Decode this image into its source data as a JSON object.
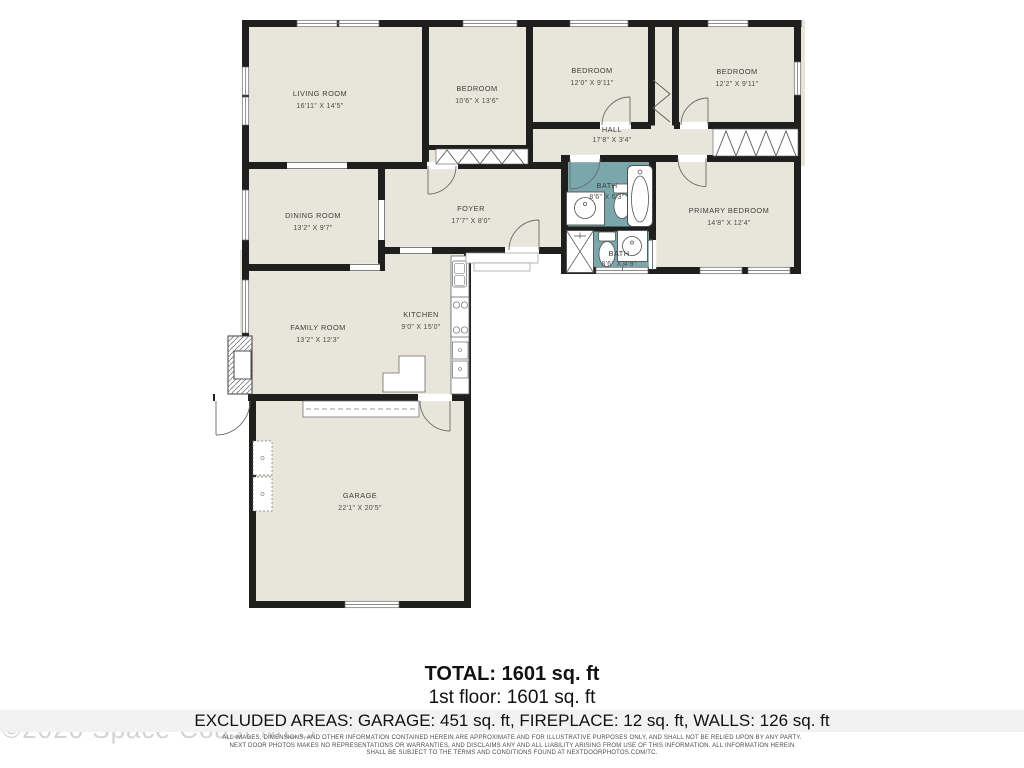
{
  "plan": {
    "rooms": {
      "living": {
        "name": "LIVING ROOM",
        "dims": "16'11\" X 14'5\""
      },
      "bedroom1": {
        "name": "BEDROOM",
        "dims": "10'6\" X 13'6\""
      },
      "bedroom2": {
        "name": "BEDROOM",
        "dims": "12'0\" X 9'11\""
      },
      "bedroom3": {
        "name": "BEDROOM",
        "dims": "12'2\" X 9'11\""
      },
      "hall": {
        "name": "HALL",
        "dims": "17'8\" X 3'4\""
      },
      "foyer": {
        "name": "FOYER",
        "dims": "17'7\" X 8'0\""
      },
      "bath1": {
        "name": "BATH",
        "dims": "8'6\" X 6'3\""
      },
      "bath2": {
        "name": "BATH",
        "dims": "8'6\" X 4'9\""
      },
      "primary": {
        "name": "PRIMARY BEDROOM",
        "dims": "14'8\" X 12'4\""
      },
      "dining": {
        "name": "DINING ROOM",
        "dims": "13'2\" X 9'7\""
      },
      "family": {
        "name": "FAMILY ROOM",
        "dims": "13'2\" X 12'3\""
      },
      "kitchen": {
        "name": "KITCHEN",
        "dims": "9'0\" X 15'0\""
      },
      "garage": {
        "name": "GARAGE",
        "dims": "22'1\" X 20'5\""
      }
    },
    "colors": {
      "wall": "#1f1f1d",
      "floor": "#e8e6db",
      "bath_accent": "#7aa7ac"
    }
  },
  "footer": {
    "total": "TOTAL: 1601 sq. ft",
    "floor1": "1st floor: 1601 sq. ft",
    "excluded": "EXCLUDED AREAS: GARAGE: 451 sq. ft, FIREPLACE: 12 sq. ft, WALLS: 126 sq. ft",
    "disclaimer_line1": "ALL IMAGES, DIMENSIONS, AND OTHER INFORMATION CONTAINED HEREIN ARE APPROXIMATE AND FOR ILLUSTRATIVE PURPOSES ONLY, AND SHALL NOT BE RELIED UPON BY ANY PARTY.",
    "disclaimer_line2": "NEXT DOOR PHOTOS MAKES NO REPRESENTATIONS OR WARRANTIES, AND DISCLAIMS ANY AND ALL LIABILITY ARISING FROM USE OF THIS INFORMATION. ALL INFORMATION HEREIN",
    "disclaimer_line3": "SHALL BE SUBJECT TO THE TERMS AND CONDITIONS FOUND AT NEXTDOORPHOTOS.COM/TC."
  },
  "watermark": {
    "text": "©2026 Space Coast MLS"
  }
}
